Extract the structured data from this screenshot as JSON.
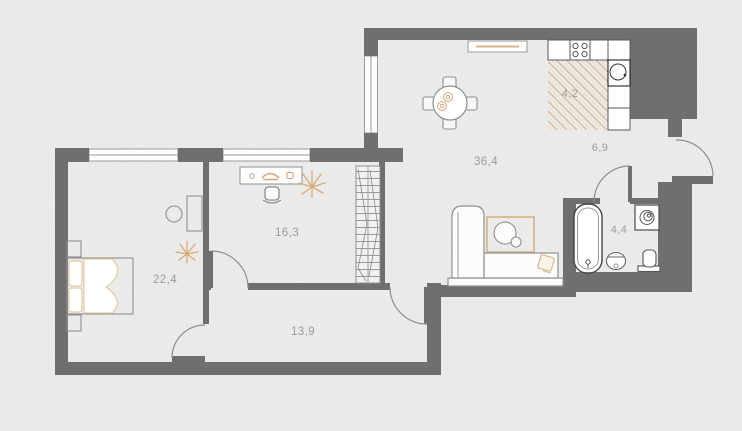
{
  "floorplan": {
    "rooms": {
      "bedroom": {
        "area_label": "22,4"
      },
      "office": {
        "area_label": "16,3"
      },
      "hallway": {
        "area_label": "13,9"
      },
      "living_room": {
        "area_label": "36,4"
      },
      "entry_hall": {
        "area_label": "6,9"
      },
      "kitchen_zone": {
        "area_label": "4,2"
      },
      "bathroom": {
        "area_label": "4,4"
      }
    },
    "colors": {
      "background": "#ececec",
      "wall": "#6f6f6f",
      "thin_line": "#8f8f8f",
      "accent_tan": "#d9b78c",
      "label_text": "#9b9b9b",
      "fixture_fill": "#ffffff"
    },
    "icons": {
      "furniture": [
        "bed-icon",
        "nightstand-icon",
        "side-table-icon",
        "dresser-icon",
        "plant-icon",
        "desk-icon",
        "desk-chair-icon",
        "wardrobe-icon",
        "dining-table-icon",
        "dining-chair-icon",
        "cup-icon",
        "sideboard-icon",
        "stove-icon",
        "kitchen-sink-icon",
        "sofa-icon",
        "rug-icon",
        "coffee-table-icon",
        "cushion-icon",
        "bathtub-icon",
        "bathroom-sink-icon",
        "toilet-icon",
        "washing-machine-icon"
      ]
    }
  }
}
